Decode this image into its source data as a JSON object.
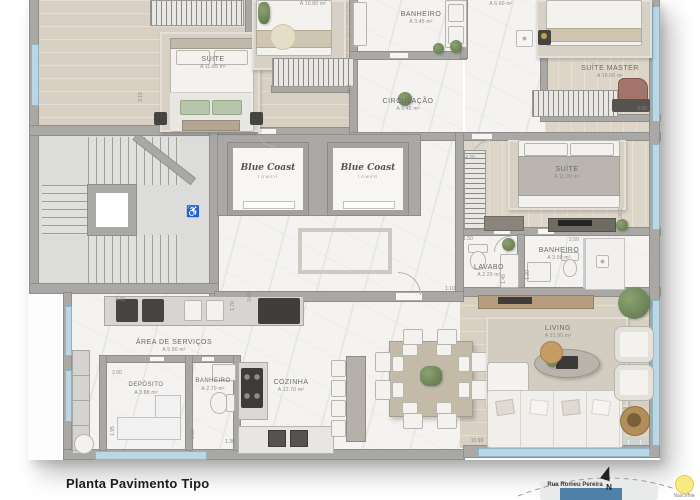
{
  "title": "Planta Pavimento Tipo",
  "brand": {
    "name": "Blue Coast",
    "sub": "TOWER"
  },
  "rooms": [
    {
      "name": "SUITE",
      "area": "A 11.85 m²"
    },
    {
      "name": "",
      "area": "A 10.80 m²"
    },
    {
      "name": "BANHEIRO",
      "area": "A 3.45 m²"
    },
    {
      "name": "",
      "area": "A 6.60 m²"
    },
    {
      "name": "SUÍTE MASTER",
      "area": "A 16.60 m²"
    },
    {
      "name": "CIRCULAÇÃO",
      "area": "A 9.45 m²"
    },
    {
      "name": "SUÍTE",
      "area": "A 11.90 m²"
    },
    {
      "name": "LAVABO",
      "area": "A 2.20 m²"
    },
    {
      "name": "BANHEIRO",
      "area": "A 3.00 m²"
    },
    {
      "name": "ÁREA DE SERVIÇOS",
      "area": "A 5.90 m²"
    },
    {
      "name": "DEPÓSITO",
      "area": "A 3.88 m²"
    },
    {
      "name": "BANHEIRO",
      "area": "A 2.70 m²"
    },
    {
      "name": "COZINHA",
      "area": "A 12.70 m²"
    },
    {
      "name": "LIVING",
      "area": "A 31.90 m²"
    }
  ],
  "dimensions": [
    "3.15",
    "3.00",
    "1.40",
    "4.20",
    "2.60",
    "2.50",
    "1.50",
    "1.20",
    "1.45",
    "3.40",
    "2.00",
    "1.95",
    "2.10",
    "1.30",
    "10.90",
    "3.00",
    "3.60",
    "1.70",
    "1.10"
  ],
  "compass": {
    "street": "Rua Romeu Pereira",
    "north_label": "N",
    "sun_label": "Nascente"
  },
  "icons": {
    "accessibility": "♿"
  }
}
